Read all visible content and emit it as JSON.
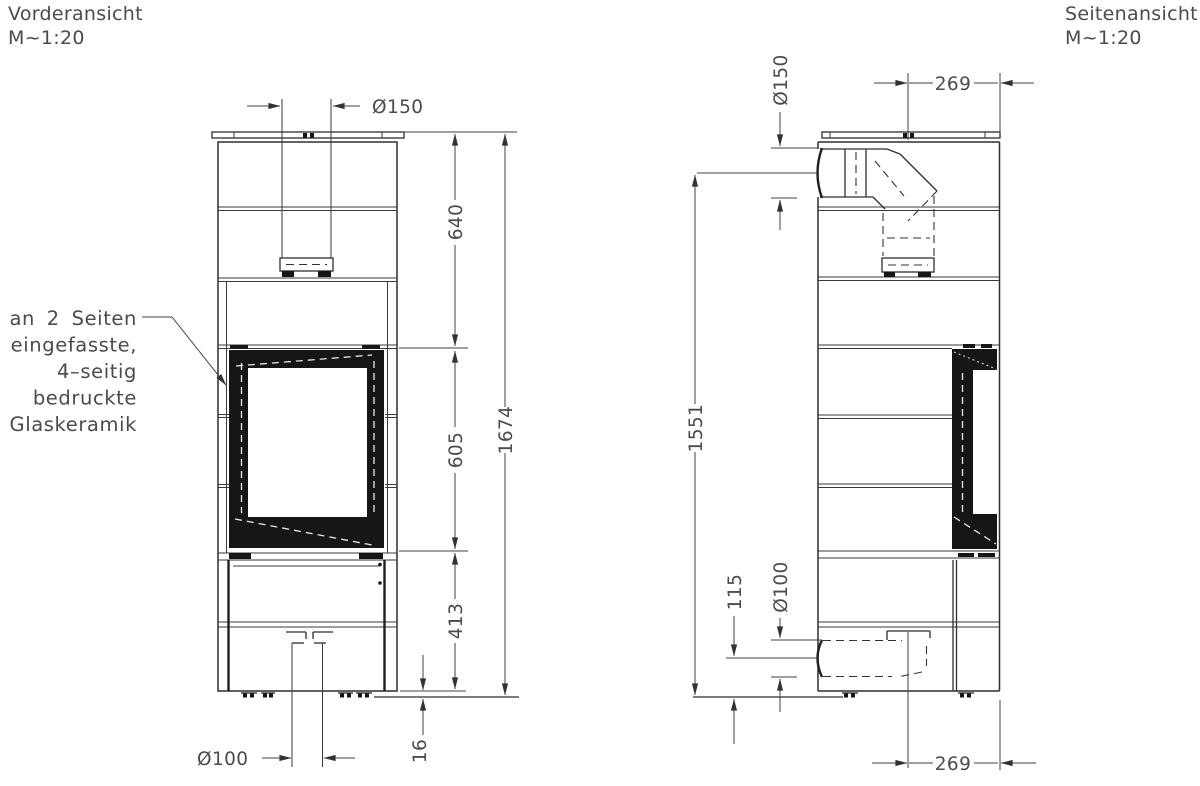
{
  "front_view": {
    "title": "Vorderansicht",
    "scale": "M~1:20",
    "annotation_lines": [
      "an 2 Seiten",
      "eingefasste,",
      "4–seitig",
      "bedruckte",
      "Glaskeramik"
    ],
    "dim_flue_diameter": "Ø150",
    "dim_top_section": "640",
    "dim_window_height": "605",
    "dim_lower_section": "413",
    "dim_total_height": "1674",
    "dim_foot_height": "16",
    "dim_air_inlet_diameter": "Ø100"
  },
  "side_view": {
    "title": "Seitenansicht",
    "scale": "M~1:20",
    "dim_flue_diameter": "Ø150",
    "dim_flue_center_to_front": "269",
    "dim_flue_center_height": "1551",
    "dim_air_inlet_center_height": "115",
    "dim_air_inlet_diameter": "Ø100",
    "dim_air_center_to_front": "269"
  },
  "colors": {
    "line": "#2e2e2e",
    "text": "#4b4b4b",
    "glass": "#161616",
    "background": "#ffffff"
  }
}
